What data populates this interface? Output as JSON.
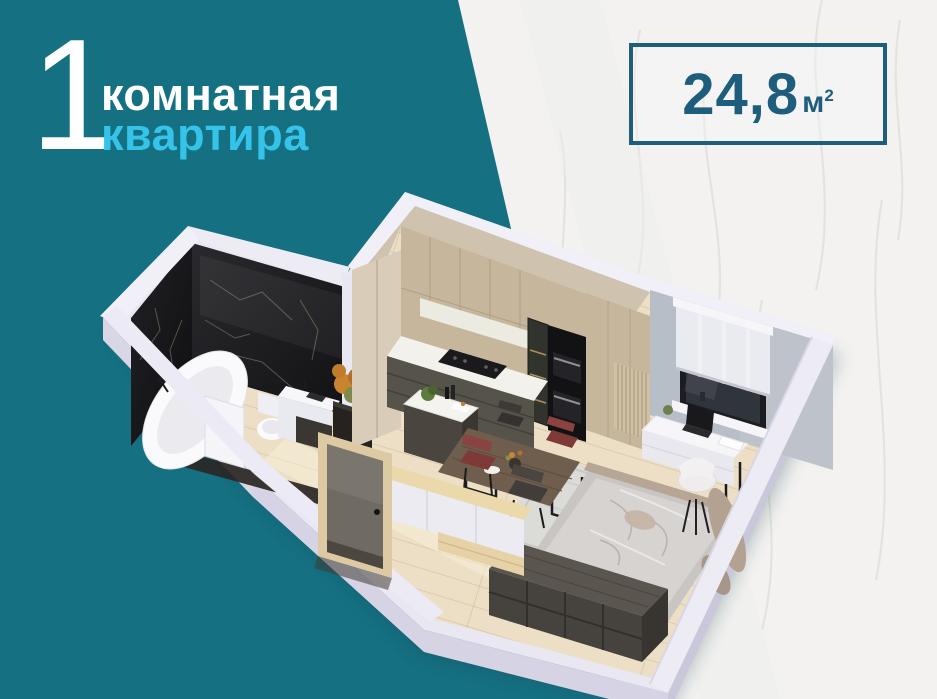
{
  "title": {
    "number": "1",
    "line1": "комнатная",
    "line2": "квартира"
  },
  "badge": {
    "value": "24,8",
    "unit": "м",
    "power": "2"
  },
  "palette": {
    "teal_background": "#157082",
    "accent_cyan": "#35c3ea",
    "badge_teal": "#1e5e7c",
    "marble_background": "#f3f2f1",
    "cut_wall_white": "#e9e7f1",
    "wood_floor": "#ecdfc6",
    "bathroom_marble": "#1a1a1d",
    "kitchen_wood": "#c6b69c",
    "lower_cabinets": "#56534b",
    "bedroom_wall_gray": "#b8bec7",
    "bed_blanket": "#d6d3d1",
    "wardrobe_dark": "#46423e",
    "chair_red": "#7d3a37"
  }
}
